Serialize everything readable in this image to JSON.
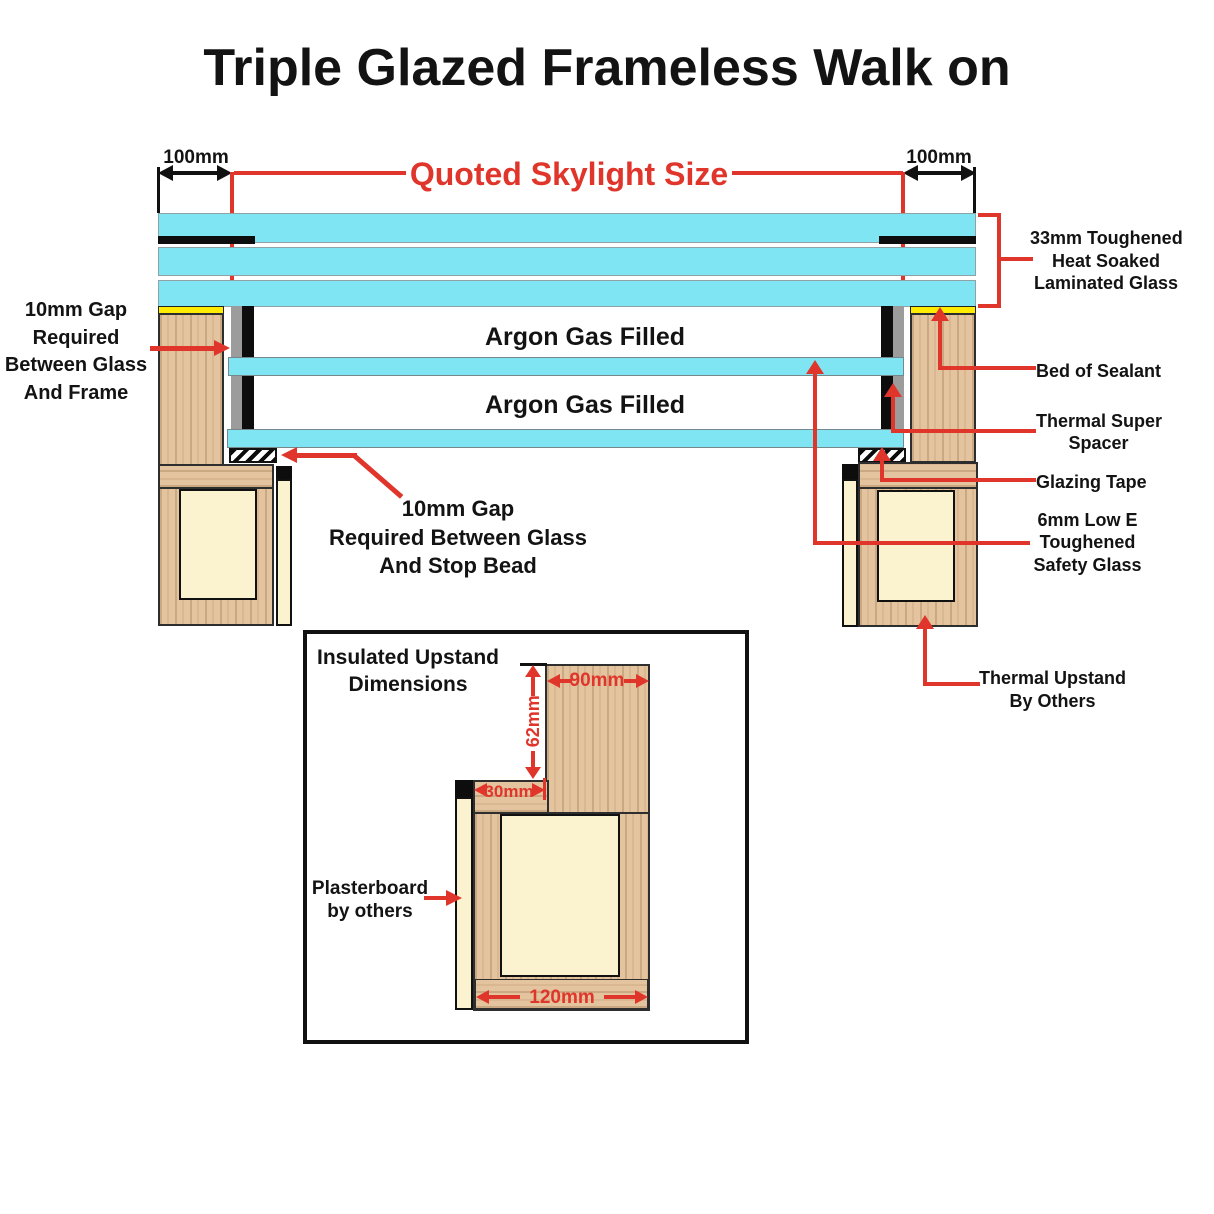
{
  "title": "Triple Glazed Frameless Walk on",
  "colors": {
    "accent_red": "#E0352B",
    "glass_cyan": "#7FE5F2",
    "wood_tan": "#E3C49E",
    "insulation_cream": "#FBF3D0",
    "sealant_yellow": "#FFEC00",
    "spacer_gray": "#9C9C9C",
    "ink_black": "#111111"
  },
  "top_dimensions": {
    "left_overhang": "100mm",
    "right_overhang": "100mm",
    "quoted_size_label": "Quoted Skylight Size"
  },
  "glazing_labels": {
    "argon_top": "Argon Gas Filled",
    "argon_bottom": "Argon Gas Filled"
  },
  "callouts": {
    "gap_frame": {
      "lines": [
        "10mm Gap",
        "Required",
        "Between Glass",
        "And Frame"
      ]
    },
    "gap_stop_bead": {
      "lines": [
        "10mm Gap",
        "Required Between Glass",
        "And Stop Bead"
      ]
    },
    "laminated_glass": {
      "lines": [
        "33mm Toughened",
        "Heat Soaked",
        "Laminated Glass"
      ]
    },
    "bed_of_sealant": {
      "label": "Bed of Sealant"
    },
    "thermal_spacer": {
      "lines": [
        "Thermal Super",
        "Spacer"
      ]
    },
    "glazing_tape": {
      "label": "Glazing Tape"
    },
    "low_e_glass": {
      "lines": [
        "6mm Low E",
        "Toughened",
        "Safety Glass"
      ]
    },
    "thermal_upstand": {
      "lines": [
        "Thermal Upstand",
        "By Others"
      ]
    }
  },
  "inset": {
    "title_lines": [
      "Insulated Upstand",
      "Dimensions"
    ],
    "dims": {
      "width_top": "90mm",
      "height_step": "62mm",
      "step": "30mm",
      "width_base": "120mm"
    },
    "plasterboard": {
      "lines": [
        "Plasterboard",
        "by others"
      ]
    }
  }
}
